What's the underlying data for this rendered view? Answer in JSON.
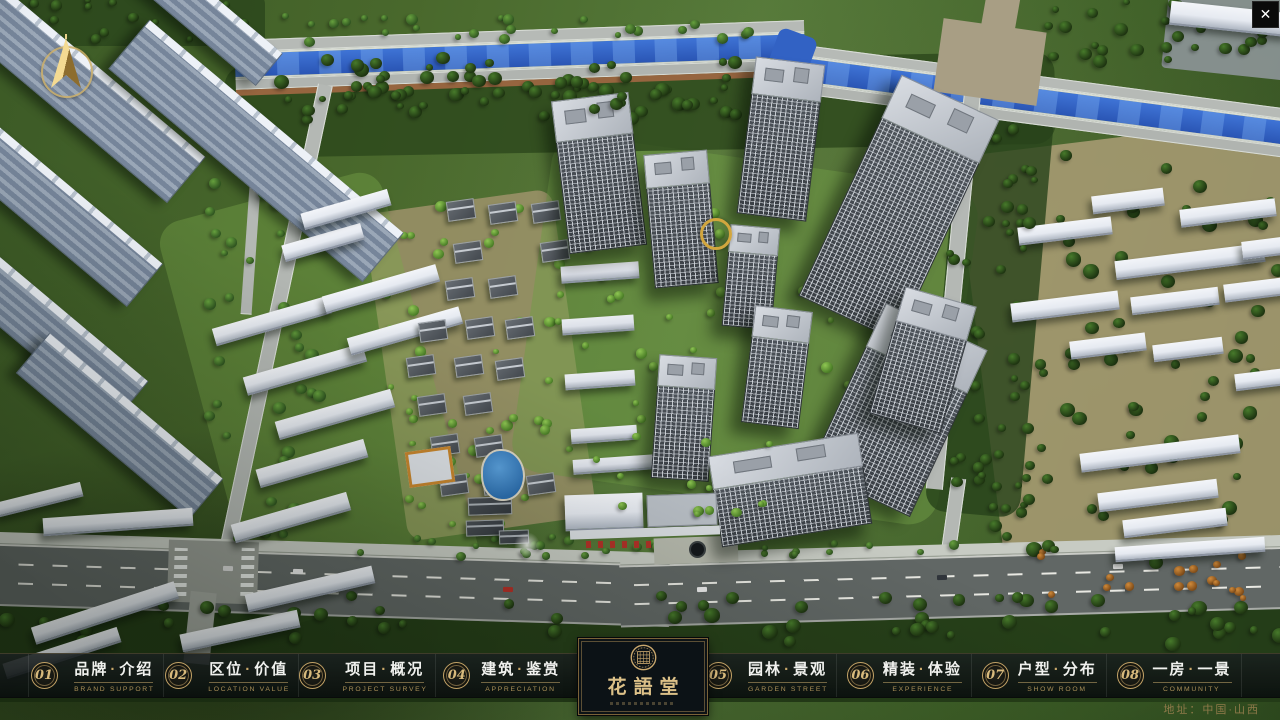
{
  "window": {
    "close_glyph": "✕"
  },
  "logo": {
    "name": "花語堂"
  },
  "nav": {
    "separator": "·",
    "items": [
      {
        "num": "01",
        "zh1": "品牌",
        "zh2": "介绍",
        "en": "BRAND SUPPORT"
      },
      {
        "num": "02",
        "zh1": "区位",
        "zh2": "价值",
        "en": "LOCATION VALUE"
      },
      {
        "num": "03",
        "zh1": "项目",
        "zh2": "概况",
        "en": "PROJECT SURVEY"
      },
      {
        "num": "04",
        "zh1": "建筑",
        "zh2": "鉴赏",
        "en": "APPRECIATION"
      },
      {
        "num": "05",
        "zh1": "园林",
        "zh2": "景观",
        "en": "GARDEN STREET"
      },
      {
        "num": "06",
        "zh1": "精装",
        "zh2": "体验",
        "en": "EXPERIENCE"
      },
      {
        "num": "07",
        "zh1": "户型",
        "zh2": "分布",
        "en": "SHOW ROOM"
      },
      {
        "num": "08",
        "zh1": "一房",
        "zh2": "一景",
        "en": "COMMUNITY"
      }
    ]
  },
  "footer": {
    "address": "地址：中国·山西"
  },
  "colors": {
    "gold": "#c9a86a",
    "bar_bg": "rgba(12,17,17,0.85)",
    "text": "#f0f1ee",
    "river": "#2f63c4"
  }
}
